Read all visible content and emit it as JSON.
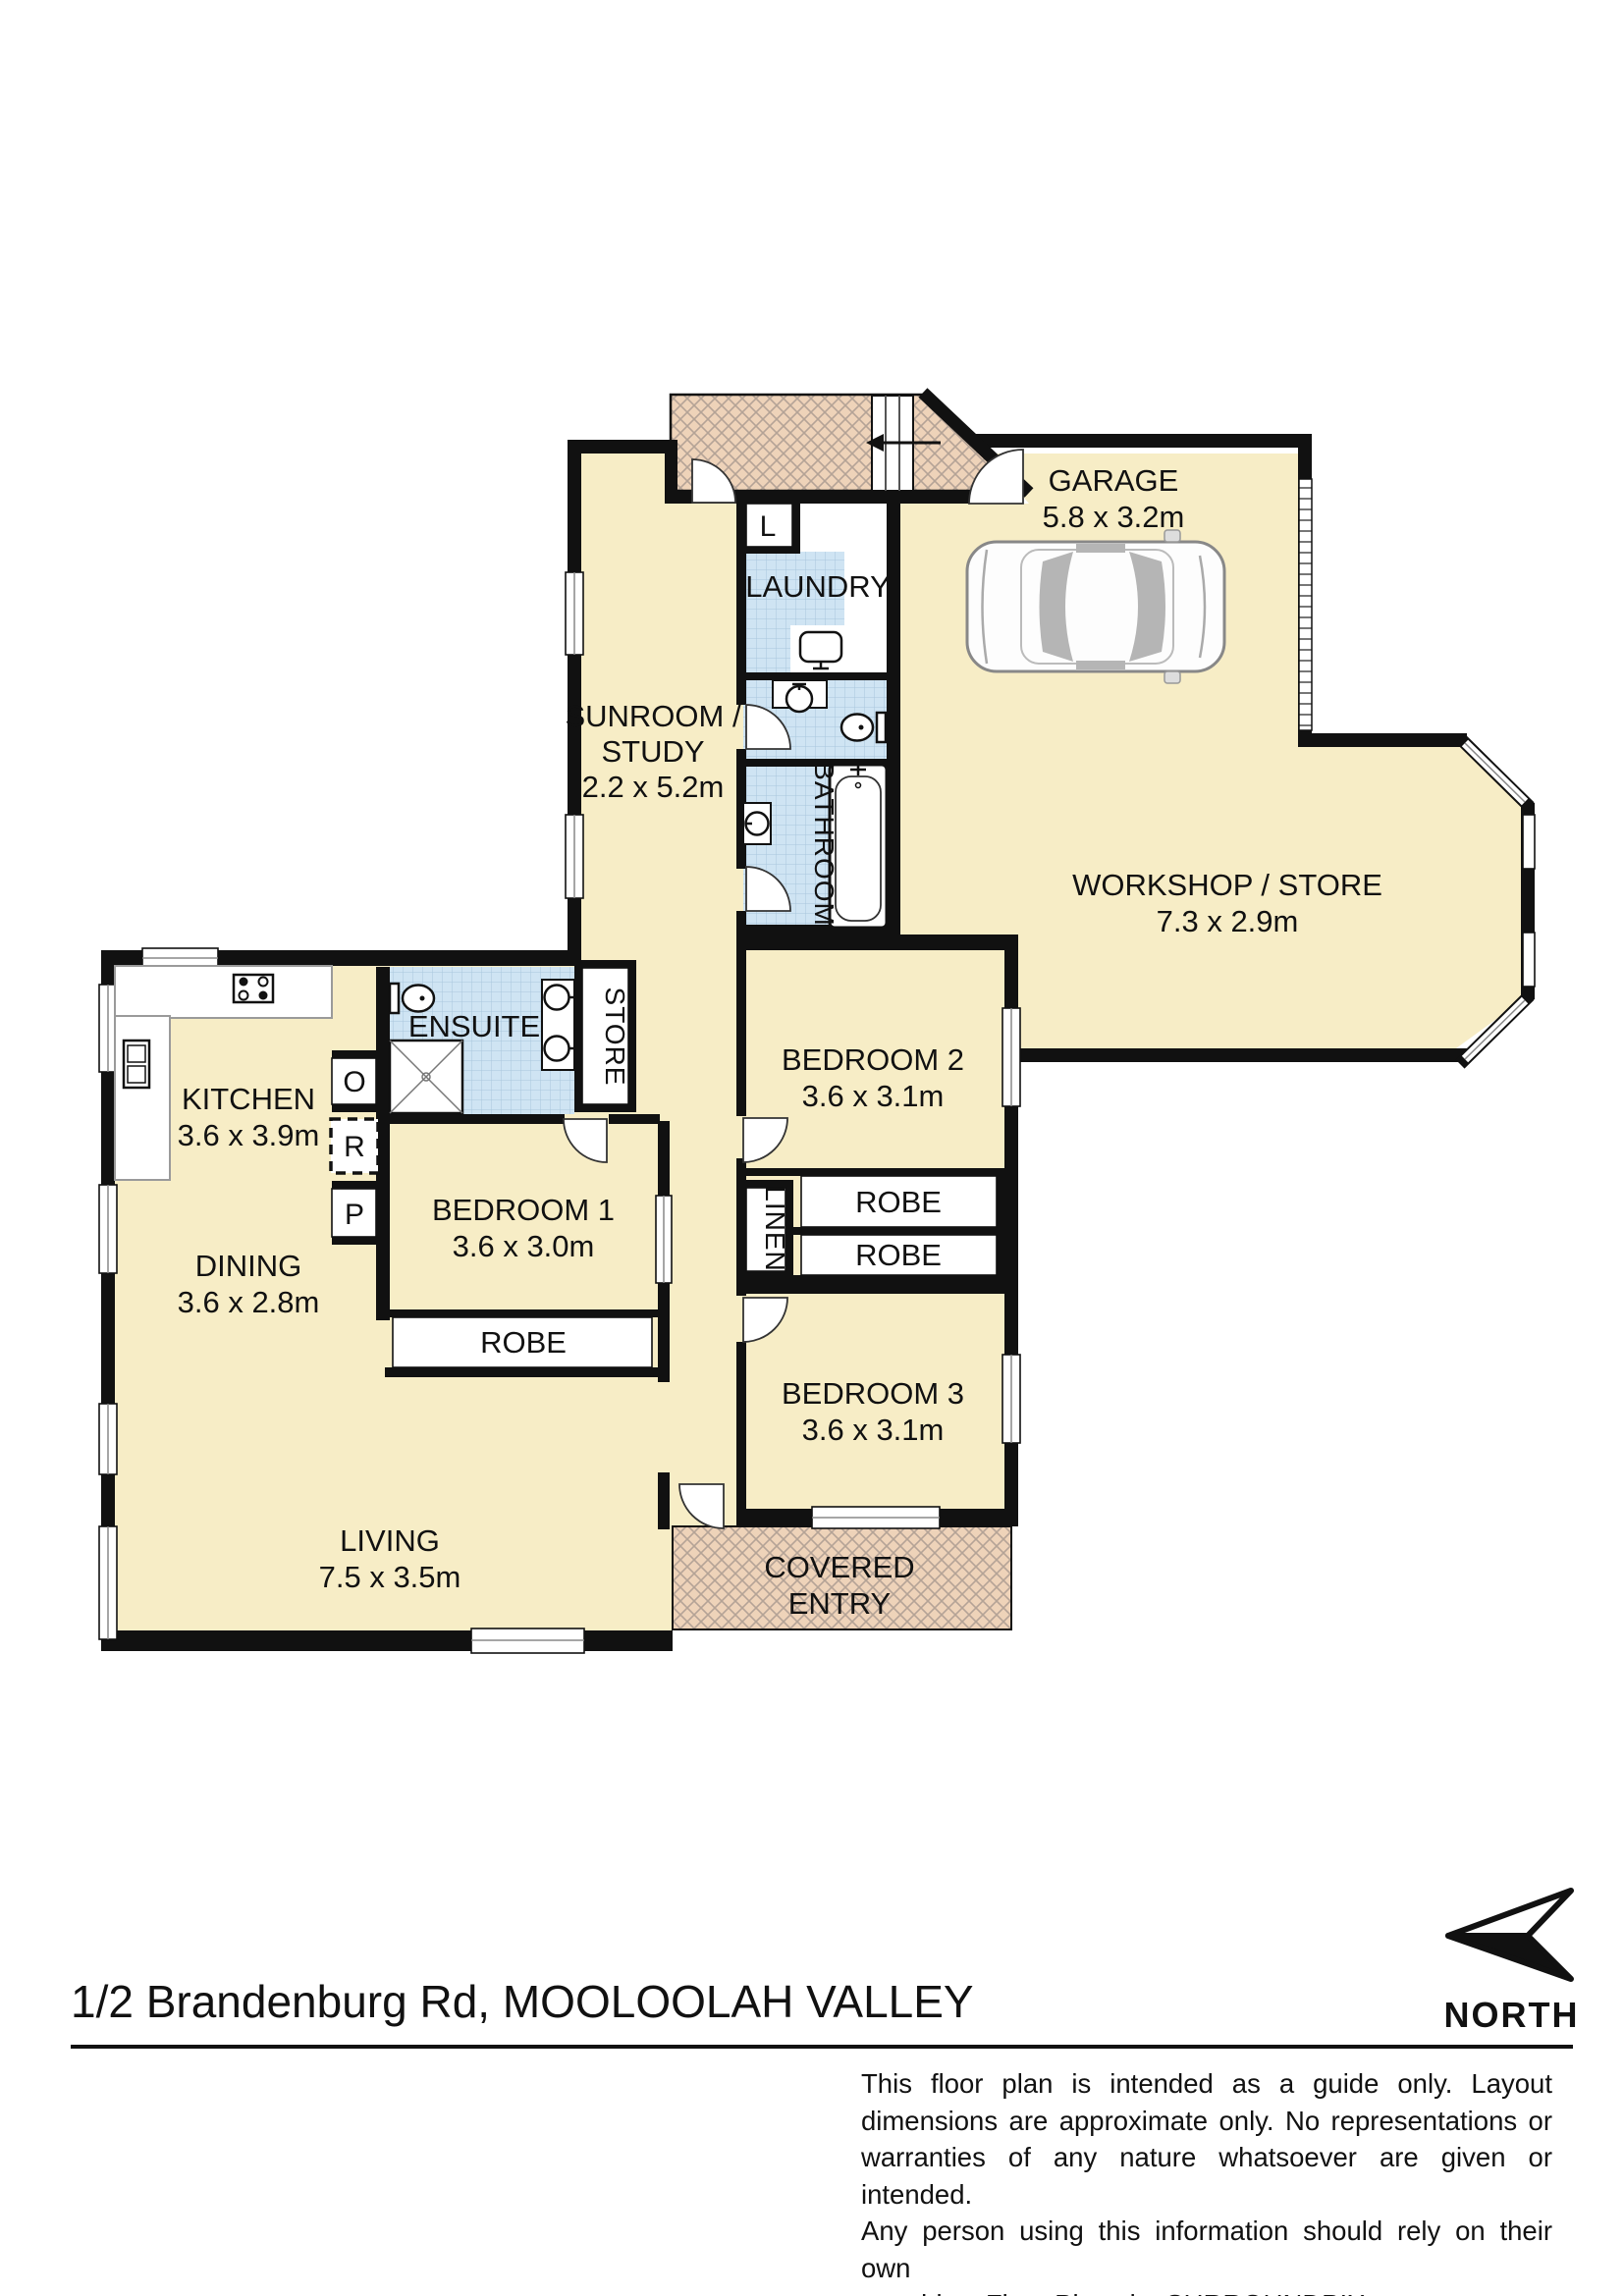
{
  "page": {
    "title": "1/2 Brandenburg Rd, MOOLOOLAH VALLEY",
    "north_label": "NORTH"
  },
  "disclaimer": {
    "line1": "This floor plan is intended as a guide only. Layout",
    "line2": "dimensions are approximate only. No representations or",
    "line3": "warranties of any nature whatsoever are given or intended.",
    "line4": "Any person using this information should rely on their own",
    "line5": "enquiries. Floor Plans by  SURROUNDPIX."
  },
  "rooms": {
    "garage": {
      "name": "GARAGE",
      "dims": "5.8 x 3.2m"
    },
    "workshop": {
      "name": "WORKSHOP / STORE",
      "dims": "7.3 x 2.9m"
    },
    "sunroom": {
      "name_line1": "SUNROOM /",
      "name_line2": "STUDY",
      "dims": "2.2 x 5.2m"
    },
    "laundry": {
      "name": "LAUNDRY"
    },
    "bathroom": {
      "name": "BATHROOM"
    },
    "ensuite": {
      "name": "ENSUITE"
    },
    "kitchen": {
      "name": "KITCHEN",
      "dims": "3.6 x 3.9m"
    },
    "dining": {
      "name": "DINING",
      "dims": "3.6 x 2.8m"
    },
    "living": {
      "name": "LIVING",
      "dims": "7.5 x 3.5m"
    },
    "bedroom1": {
      "name": "BEDROOM 1",
      "dims": "3.6 x 3.0m"
    },
    "bedroom2": {
      "name": "BEDROOM 2",
      "dims": "3.6 x 3.1m"
    },
    "bedroom3": {
      "name": "BEDROOM 3",
      "dims": "3.6 x 3.1m"
    },
    "covered_entry": {
      "name_line1": "COVERED",
      "name_line2": "ENTRY"
    }
  },
  "closets": {
    "store": "STORE",
    "linen": "LINEN",
    "robe_bed1": "ROBE",
    "robe_bed2_top": "ROBE",
    "robe_bed2_bottom": "ROBE",
    "laundry_cupboard": "L",
    "oven": "O",
    "refrigerator": "R",
    "pantry": "P"
  },
  "colors": {
    "room_fill": "#f7edc6",
    "wall": "#111111",
    "tile_fill": "#cfe4f3",
    "tile_line": "#a9c6dd",
    "hatch_fill": "#eed3b9",
    "hatch_line": "#b4a396"
  }
}
